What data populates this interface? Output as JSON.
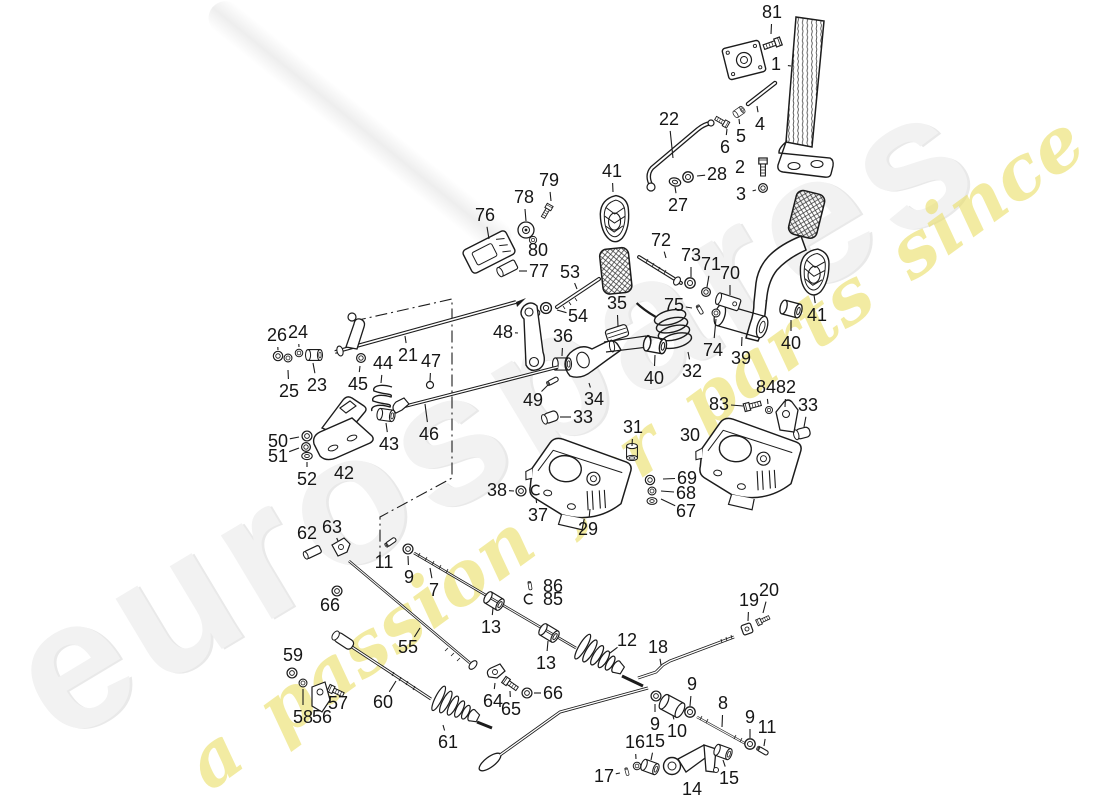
{
  "page": {
    "background": "#ffffff",
    "line_color": "#1c1c1c"
  },
  "watermark": {
    "brand_text": "eurospares",
    "tagline_text": "a passion for parts since 1985",
    "brand_color": "#f2f2f2",
    "tagline_color": "rgba(233,221,95,0.58)"
  },
  "diagram": {
    "description": "Exploded parts diagram - pedals and foot controls with numbered callouts",
    "callouts": [
      {
        "n": "1",
        "x": 776,
        "y": 64,
        "tx": 791,
        "ty": 66
      },
      {
        "n": "81",
        "x": 772,
        "y": 12,
        "tx": 771,
        "ty": 34
      },
      {
        "n": "22",
        "x": 669,
        "y": 119,
        "tx": 673,
        "ty": 158
      },
      {
        "n": "4",
        "x": 760,
        "y": 124,
        "tx": 757,
        "ty": 106
      },
      {
        "n": "5",
        "x": 741,
        "y": 136,
        "tx": 739,
        "ty": 119
      },
      {
        "n": "6",
        "x": 725,
        "y": 147,
        "tx": 727,
        "ty": 129
      },
      {
        "n": "2",
        "x": 740,
        "y": 167,
        "tx": 754,
        "ty": 168
      },
      {
        "n": "28",
        "x": 717,
        "y": 174,
        "tx": 697,
        "ty": 176
      },
      {
        "n": "3",
        "x": 741,
        "y": 194,
        "tx": 756,
        "ty": 190
      },
      {
        "n": "27",
        "x": 678,
        "y": 205,
        "tx": 675,
        "ty": 187
      },
      {
        "n": "41",
        "x": 612,
        "y": 171,
        "tx": 613,
        "ty": 192
      },
      {
        "n": "79",
        "x": 549,
        "y": 180,
        "tx": 551,
        "ty": 201
      },
      {
        "n": "78",
        "x": 524,
        "y": 197,
        "tx": 526,
        "ty": 221
      },
      {
        "n": "76",
        "x": 485,
        "y": 215,
        "tx": 489,
        "ty": 239
      },
      {
        "n": "80",
        "x": 538,
        "y": 250,
        "tx": 534,
        "ty": 241
      },
      {
        "n": "77",
        "x": 539,
        "y": 271,
        "tx": 519,
        "ty": 271
      },
      {
        "n": "53",
        "x": 570,
        "y": 272,
        "tx": 577,
        "ty": 289
      },
      {
        "n": "72",
        "x": 661,
        "y": 240,
        "tx": 666,
        "ty": 258
      },
      {
        "n": "73",
        "x": 691,
        "y": 255,
        "tx": 691,
        "ty": 277
      },
      {
        "n": "71",
        "x": 711,
        "y": 264,
        "tx": 707,
        "ty": 287
      },
      {
        "n": "70",
        "x": 730,
        "y": 273,
        "tx": 730,
        "ty": 295
      },
      {
        "n": "35",
        "x": 617,
        "y": 303,
        "tx": 618,
        "ty": 326
      },
      {
        "n": "54",
        "x": 578,
        "y": 316,
        "tx": 557,
        "ty": 310
      },
      {
        "n": "75",
        "x": 674,
        "y": 305,
        "tx": 692,
        "ty": 308
      },
      {
        "n": "48",
        "x": 503,
        "y": 332,
        "tx": 518,
        "ty": 333
      },
      {
        "n": "36",
        "x": 563,
        "y": 336,
        "tx": 562,
        "ty": 356
      },
      {
        "n": "21",
        "x": 408,
        "y": 355,
        "tx": 405,
        "ty": 336
      },
      {
        "n": "47",
        "x": 431,
        "y": 361,
        "tx": 430,
        "ty": 381
      },
      {
        "n": "44",
        "x": 383,
        "y": 363,
        "tx": 381,
        "ty": 383
      },
      {
        "n": "45",
        "x": 358,
        "y": 384,
        "tx": 360,
        "ty": 366
      },
      {
        "n": "23",
        "x": 317,
        "y": 385,
        "tx": 313,
        "ty": 363
      },
      {
        "n": "25",
        "x": 289,
        "y": 391,
        "tx": 288,
        "ty": 370
      },
      {
        "n": "26",
        "x": 277,
        "y": 335,
        "tx": 278,
        "ty": 350
      },
      {
        "n": "24",
        "x": 298,
        "y": 332,
        "tx": 299,
        "ty": 347
      },
      {
        "n": "74",
        "x": 713,
        "y": 350,
        "tx": 716,
        "ty": 319
      },
      {
        "n": "32",
        "x": 692,
        "y": 371,
        "tx": 688,
        "ty": 352
      },
      {
        "n": "39",
        "x": 741,
        "y": 358,
        "tx": 742,
        "ty": 337
      },
      {
        "n": "40",
        "x": 654,
        "y": 378,
        "tx": 655,
        "ty": 355
      },
      {
        "n": "40",
        "x": 791,
        "y": 343,
        "tx": 791,
        "ty": 320
      },
      {
        "n": "41",
        "x": 817,
        "y": 315,
        "tx": 814,
        "ty": 295
      },
      {
        "n": "42",
        "x": 344,
        "y": 473,
        "tx": 341,
        "ty": 460
      },
      {
        "n": "43",
        "x": 389,
        "y": 444,
        "tx": 386,
        "ty": 423
      },
      {
        "n": "46",
        "x": 429,
        "y": 434,
        "tx": 425,
        "ty": 404
      },
      {
        "n": "49",
        "x": 533,
        "y": 400,
        "tx": 548,
        "ty": 385
      },
      {
        "n": "50",
        "x": 278,
        "y": 441,
        "tx": 299,
        "ty": 437
      },
      {
        "n": "51",
        "x": 278,
        "y": 456,
        "tx": 299,
        "ty": 448
      },
      {
        "n": "52",
        "x": 307,
        "y": 479,
        "tx": 307,
        "ty": 462
      },
      {
        "n": "33",
        "x": 583,
        "y": 417,
        "tx": 560,
        "ty": 417
      },
      {
        "n": "31",
        "x": 633,
        "y": 427,
        "tx": 632,
        "ty": 446
      },
      {
        "n": "34",
        "x": 594,
        "y": 399,
        "tx": 589,
        "ty": 383
      },
      {
        "n": "30",
        "x": 690,
        "y": 435,
        "tx": 703,
        "ty": 437
      },
      {
        "n": "29",
        "x": 588,
        "y": 529,
        "tx": 590,
        "ty": 509
      },
      {
        "n": "38",
        "x": 497,
        "y": 490,
        "tx": 514,
        "ty": 491
      },
      {
        "n": "37",
        "x": 538,
        "y": 515,
        "tx": 536,
        "ty": 498
      },
      {
        "n": "69",
        "x": 687,
        "y": 478,
        "tx": 663,
        "ty": 479
      },
      {
        "n": "68",
        "x": 686,
        "y": 493,
        "tx": 661,
        "ty": 491
      },
      {
        "n": "67",
        "x": 686,
        "y": 511,
        "tx": 661,
        "ty": 499
      },
      {
        "n": "83",
        "x": 719,
        "y": 404,
        "tx": 743,
        "ty": 406
      },
      {
        "n": "84",
        "x": 766,
        "y": 387,
        "tx": 768,
        "ty": 404
      },
      {
        "n": "82",
        "x": 786,
        "y": 387,
        "tx": 785,
        "ty": 407
      },
      {
        "n": "33",
        "x": 808,
        "y": 405,
        "tx": 804,
        "ty": 427
      },
      {
        "n": "62",
        "x": 307,
        "y": 533,
        "tx": 312,
        "ty": 545
      },
      {
        "n": "63",
        "x": 332,
        "y": 527,
        "tx": 338,
        "ty": 541
      },
      {
        "n": "66",
        "x": 330,
        "y": 605,
        "tx": 336,
        "ty": 597
      },
      {
        "n": "11",
        "x": 384,
        "y": 562,
        "tx": 389,
        "ty": 549
      },
      {
        "n": "9",
        "x": 409,
        "y": 577,
        "tx": 408,
        "ty": 556
      },
      {
        "n": "7",
        "x": 434,
        "y": 590,
        "tx": 430,
        "ty": 568
      },
      {
        "n": "55",
        "x": 408,
        "y": 647,
        "tx": 420,
        "ty": 628
      },
      {
        "n": "59",
        "x": 293,
        "y": 655,
        "tx": 292,
        "ty": 668
      },
      {
        "n": "57",
        "x": 338,
        "y": 703,
        "tx": 335,
        "ty": 694
      },
      {
        "n": "60",
        "x": 383,
        "y": 702,
        "tx": 396,
        "ty": 681
      },
      {
        "n": "58",
        "x": 303,
        "y": 717,
        "tx": 303,
        "ty": 689
      },
      {
        "n": "56",
        "x": 322,
        "y": 717,
        "tx": 319,
        "ty": 704
      },
      {
        "n": "61",
        "x": 448,
        "y": 742,
        "tx": 443,
        "ty": 725
      },
      {
        "n": "64",
        "x": 493,
        "y": 701,
        "tx": 495,
        "ty": 683
      },
      {
        "n": "65",
        "x": 511,
        "y": 709,
        "tx": 510,
        "ty": 691
      },
      {
        "n": "66",
        "x": 553,
        "y": 693,
        "tx": 534,
        "ty": 693
      },
      {
        "n": "13",
        "x": 491,
        "y": 627,
        "tx": 493,
        "ty": 608
      },
      {
        "n": "13",
        "x": 546,
        "y": 663,
        "tx": 548,
        "ty": 641
      },
      {
        "n": "12",
        "x": 627,
        "y": 640,
        "tx": 610,
        "ty": 653
      },
      {
        "n": "18",
        "x": 658,
        "y": 647,
        "tx": 661,
        "ty": 665
      },
      {
        "n": "19",
        "x": 749,
        "y": 600,
        "tx": 748,
        "ty": 621
      },
      {
        "n": "20",
        "x": 769,
        "y": 590,
        "tx": 763,
        "ty": 613
      },
      {
        "n": "9",
        "x": 692,
        "y": 684,
        "tx": 690,
        "ty": 706
      },
      {
        "n": "8",
        "x": 723,
        "y": 703,
        "tx": 722,
        "ty": 727
      },
      {
        "n": "9",
        "x": 750,
        "y": 717,
        "tx": 750,
        "ty": 738
      },
      {
        "n": "11",
        "x": 767,
        "y": 727,
        "tx": 764,
        "ty": 746
      },
      {
        "n": "9",
        "x": 655,
        "y": 724,
        "tx": 655,
        "ty": 704
      },
      {
        "n": "10",
        "x": 677,
        "y": 731,
        "tx": 673,
        "ty": 716
      },
      {
        "n": "16",
        "x": 635,
        "y": 742,
        "tx": 636,
        "ty": 759
      },
      {
        "n": "15",
        "x": 655,
        "y": 741,
        "tx": 651,
        "ty": 760
      },
      {
        "n": "17",
        "x": 604,
        "y": 776,
        "tx": 620,
        "ty": 773,
        "dash": true
      },
      {
        "n": "14",
        "x": 692,
        "y": 789,
        "tx": 687,
        "ty": 776
      },
      {
        "n": "15",
        "x": 729,
        "y": 778,
        "tx": 723,
        "ty": 760
      },
      {
        "n": "86",
        "x": 553,
        "y": 586,
        "tx": 540,
        "ty": 586
      },
      {
        "n": "85",
        "x": 553,
        "y": 599,
        "tx": 540,
        "ty": 599
      }
    ]
  }
}
